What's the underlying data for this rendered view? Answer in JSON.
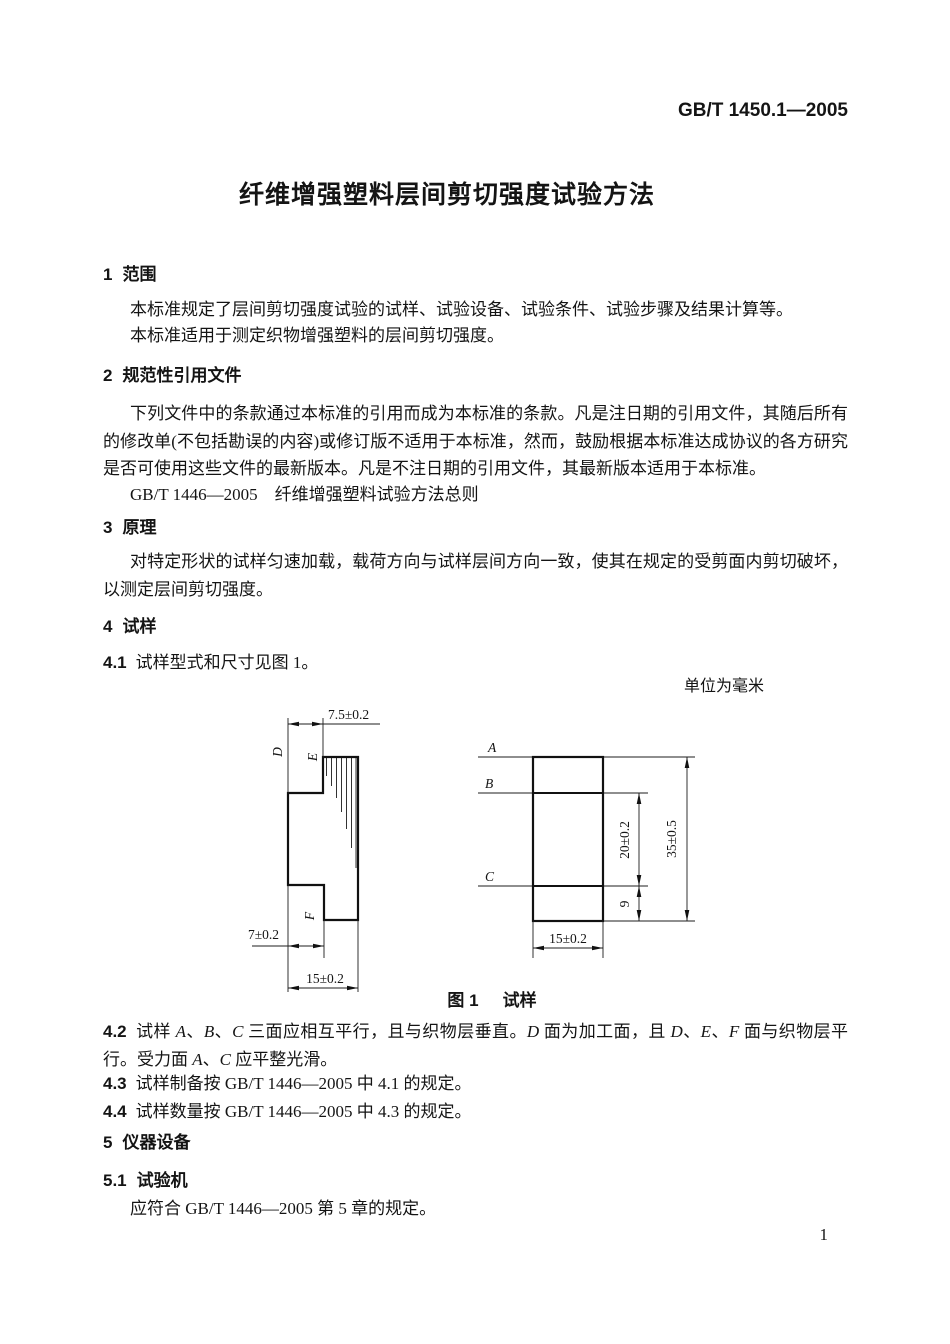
{
  "doc": {
    "header_code": "GB/T 1450.1—2005",
    "title": "纤维增强塑料层间剪切强度试验方法",
    "page_number": "1"
  },
  "s1": {
    "num": "1",
    "title": "范围",
    "p1": "本标准规定了层间剪切强度试验的试样、试验设备、试验条件、试验步骤及结果计算等。",
    "p2": "本标准适用于测定织物增强塑料的层间剪切强度。"
  },
  "s2": {
    "num": "2",
    "title": "规范性引用文件",
    "p1": "下列文件中的条款通过本标准的引用而成为本标准的条款。凡是注日期的引用文件，其随后所有的修改单(不包括勘误的内容)或修订版不适用于本标准，然而，鼓励根据本标准达成协议的各方研究是否可使用这些文件的最新版本。凡是不注日期的引用文件，其最新版本适用于本标准。",
    "ref": "GB/T 1446—2005　纤维增强塑料试验方法总则"
  },
  "s3": {
    "num": "3",
    "title": "原理",
    "p1": "对特定形状的试样匀速加载，载荷方向与试样层间方向一致，使其在规定的受剪面内剪切破坏，以测定层间剪切强度。"
  },
  "s4": {
    "num": "4",
    "title": "试样",
    "c41_num": "4.1",
    "c41": "试样型式和尺寸见图 1。",
    "c42_num": "4.2",
    "c42_segments": [
      {
        "t": "试样 "
      },
      {
        "t": "A",
        "i": true
      },
      {
        "t": "、"
      },
      {
        "t": "B",
        "i": true
      },
      {
        "t": "、"
      },
      {
        "t": "C",
        "i": true
      },
      {
        "t": " 三面应相互平行，且与织物层垂直。"
      },
      {
        "t": "D",
        "i": true
      },
      {
        "t": " 面为加工面，且 "
      },
      {
        "t": "D",
        "i": true
      },
      {
        "t": "、"
      },
      {
        "t": "E",
        "i": true
      },
      {
        "t": "、"
      },
      {
        "t": "F",
        "i": true
      },
      {
        "t": " 面与织物层平行。受力面 "
      },
      {
        "t": "A",
        "i": true
      },
      {
        "t": "、"
      },
      {
        "t": "C",
        "i": true
      },
      {
        "t": " 应平整光滑。"
      }
    ],
    "c43_num": "4.3",
    "c43": "试样制备按 GB/T 1446—2005 中 4.1 的规定。",
    "c44_num": "4.4",
    "c44": "试样数量按 GB/T 1446—2005 中 4.3 的规定。"
  },
  "s5": {
    "num": "5",
    "title": "仪器设备",
    "c51_num": "5.1",
    "c51_title": "试验机",
    "p1": "应符合 GB/T 1446—2005 第 5 章的规定。"
  },
  "figure": {
    "unit_note": "单位为毫米",
    "caption_label": "图 1",
    "caption_text": "试样",
    "side_view": {
      "dim_top": "7.5±0.2",
      "dim_bottom_left": "7±0.2",
      "dim_width": "15±0.2",
      "label_d": "D",
      "label_e": "E",
      "label_f": "F"
    },
    "front_view": {
      "label_a": "A",
      "label_b": "B",
      "label_c": "C",
      "dim_mid": "20±0.2",
      "dim_lower": "9",
      "dim_total": "35±0.5",
      "dim_width": "15±0.2"
    }
  }
}
